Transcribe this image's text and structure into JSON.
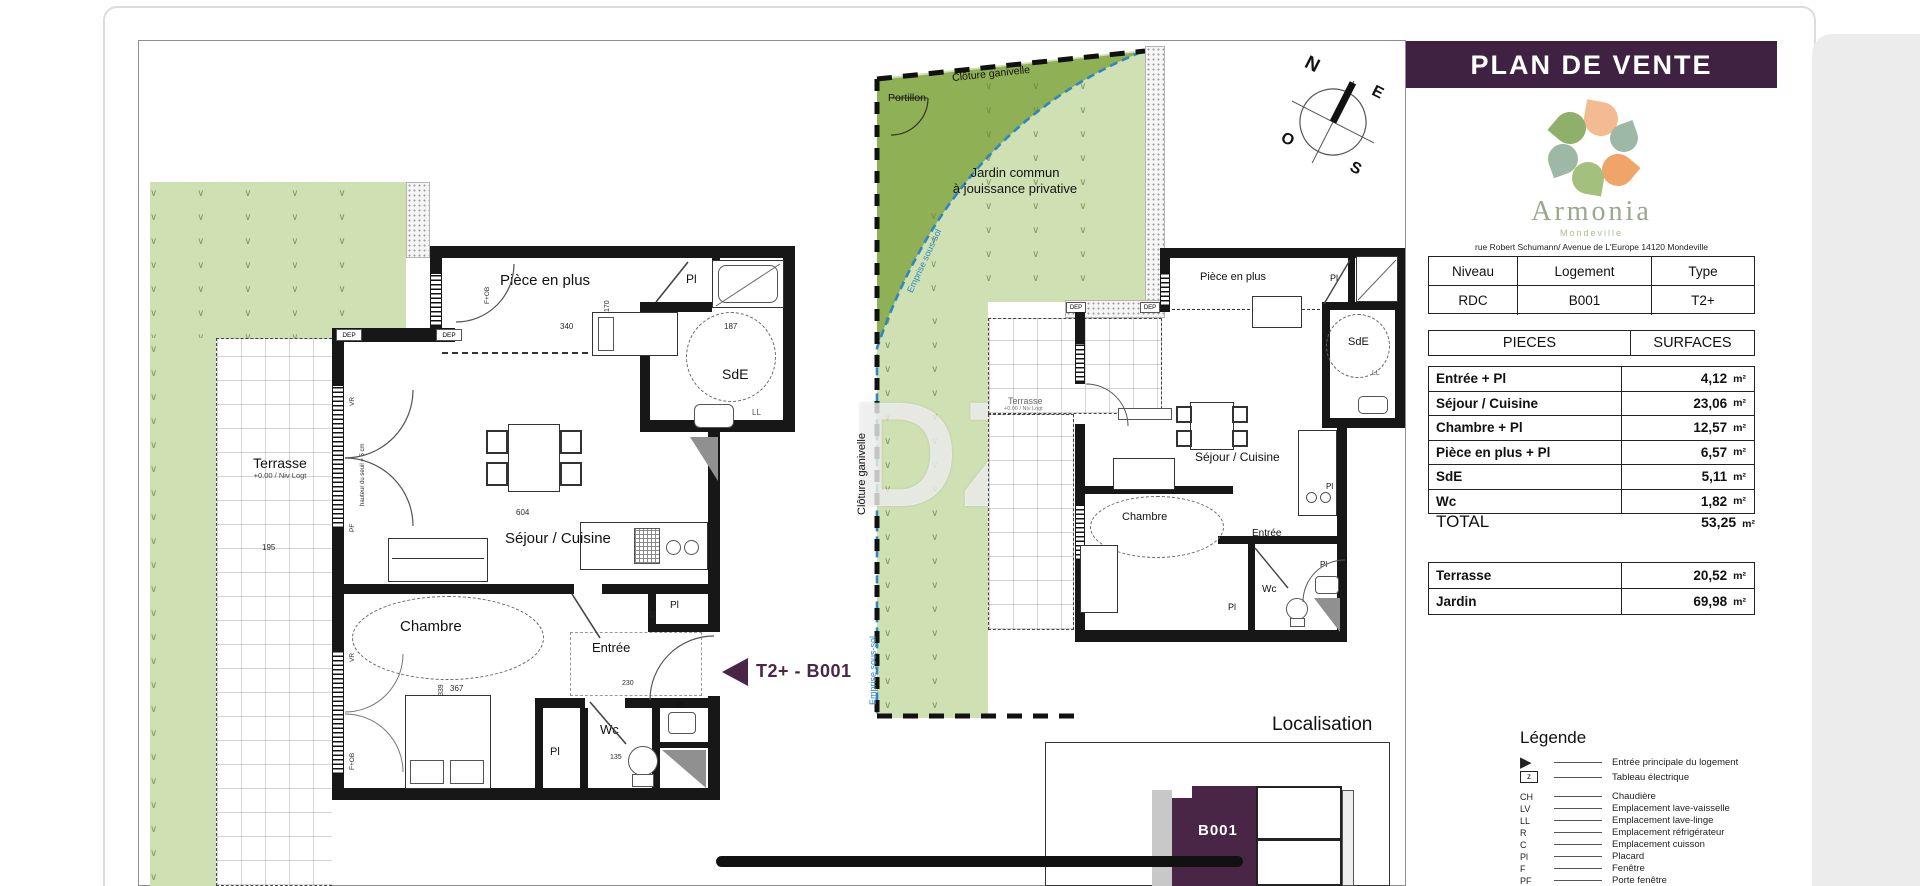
{
  "page": {
    "background": "#ffffff",
    "viewer_gray": "#ececec"
  },
  "colors": {
    "header_purple": "#3f2142",
    "accent_purple": "#4a2646",
    "light_green": "#cfe0b2",
    "dark_green": "#8fb054",
    "fence_blue": "#2f86c4"
  },
  "compass": {
    "n": "N",
    "e": "E",
    "s": "S",
    "o": "O"
  },
  "watermark": "DZ",
  "panel": {
    "title": "PLAN DE VENTE",
    "brand": {
      "name": "Armonia",
      "city": "Mondeville",
      "address": "rue Robert Schumann/ Avenue de L'Europe 14120 Mondeville"
    },
    "unit_table": {
      "headers": [
        "Niveau",
        "Logement",
        "Type"
      ],
      "values": [
        "RDC",
        "B001",
        "T2+"
      ]
    },
    "surface_table": {
      "headers": [
        "PIECES",
        "SURFACES"
      ],
      "unit": "m²",
      "rows": [
        {
          "label": "Entrée + Pl",
          "value": "4,12"
        },
        {
          "label": "Séjour / Cuisine",
          "value": "23,06"
        },
        {
          "label": "Chambre + Pl",
          "value": "12,57"
        },
        {
          "label": "Pièce en plus + Pl",
          "value": "6,57"
        },
        {
          "label": "SdE",
          "value": "5,11"
        },
        {
          "label": "Wc",
          "value": "1,82"
        }
      ],
      "total_label": "TOTAL",
      "total_value": "53,25"
    },
    "exterior_table": {
      "rows": [
        {
          "label": "Terrasse",
          "value": "20,52"
        },
        {
          "label": "Jardin",
          "value": "69,98"
        }
      ]
    },
    "legend": {
      "title": "Légende",
      "items": [
        {
          "symbol": "▶",
          "label": "Entrée principale du logement"
        },
        {
          "symbol": "z",
          "label": "Tableau électrique"
        },
        {
          "symbol": "CH",
          "label": "Chaudière"
        },
        {
          "symbol": "LV",
          "label": "Emplacement lave-vaisselle"
        },
        {
          "symbol": "LL",
          "label": "Emplacement lave-linge"
        },
        {
          "symbol": "R",
          "label": "Emplacement réfrigérateur"
        },
        {
          "symbol": "C",
          "label": "Emplacement cuisson"
        },
        {
          "symbol": "Pl",
          "label": "Placard"
        },
        {
          "symbol": "F",
          "label": "Fenêtre"
        },
        {
          "symbol": "PF",
          "label": "Porte fenêtre"
        }
      ]
    }
  },
  "plan": {
    "arrow_label": "T2+ - B001",
    "rooms": {
      "piece_en_plus": "Pièce en plus",
      "sde": "SdE",
      "sejour": "Séjour / Cuisine",
      "chambre": "Chambre",
      "entree": "Entrée",
      "wc": "Wc",
      "pl": "Pl",
      "dep": "DEP",
      "ll": "LL"
    },
    "window_labels": {
      "vr": "VR",
      "pf": "PF",
      "fob": "F+OB",
      "seuil": "hauteur du seuil = 5 cm"
    },
    "dims": {
      "d340": "340",
      "d170": "170",
      "d187": "187",
      "d604": "604",
      "d367": "367",
      "d339": "339",
      "d230": "230",
      "d135": "135",
      "d195": "195",
      "d67": "67"
    }
  },
  "terrace": {
    "label": "Terrasse",
    "sublabel": "+0.00 / Niv Logt"
  },
  "garden": {
    "portillon": "Portillon",
    "cloture": "Clôture ganivelle",
    "jardin_line1": "Jardin commun",
    "jardin_line2": "à jouissance privative",
    "emprise": "Emprise sous-sol"
  },
  "localisation": {
    "title": "Localisation",
    "unit": "B001"
  }
}
